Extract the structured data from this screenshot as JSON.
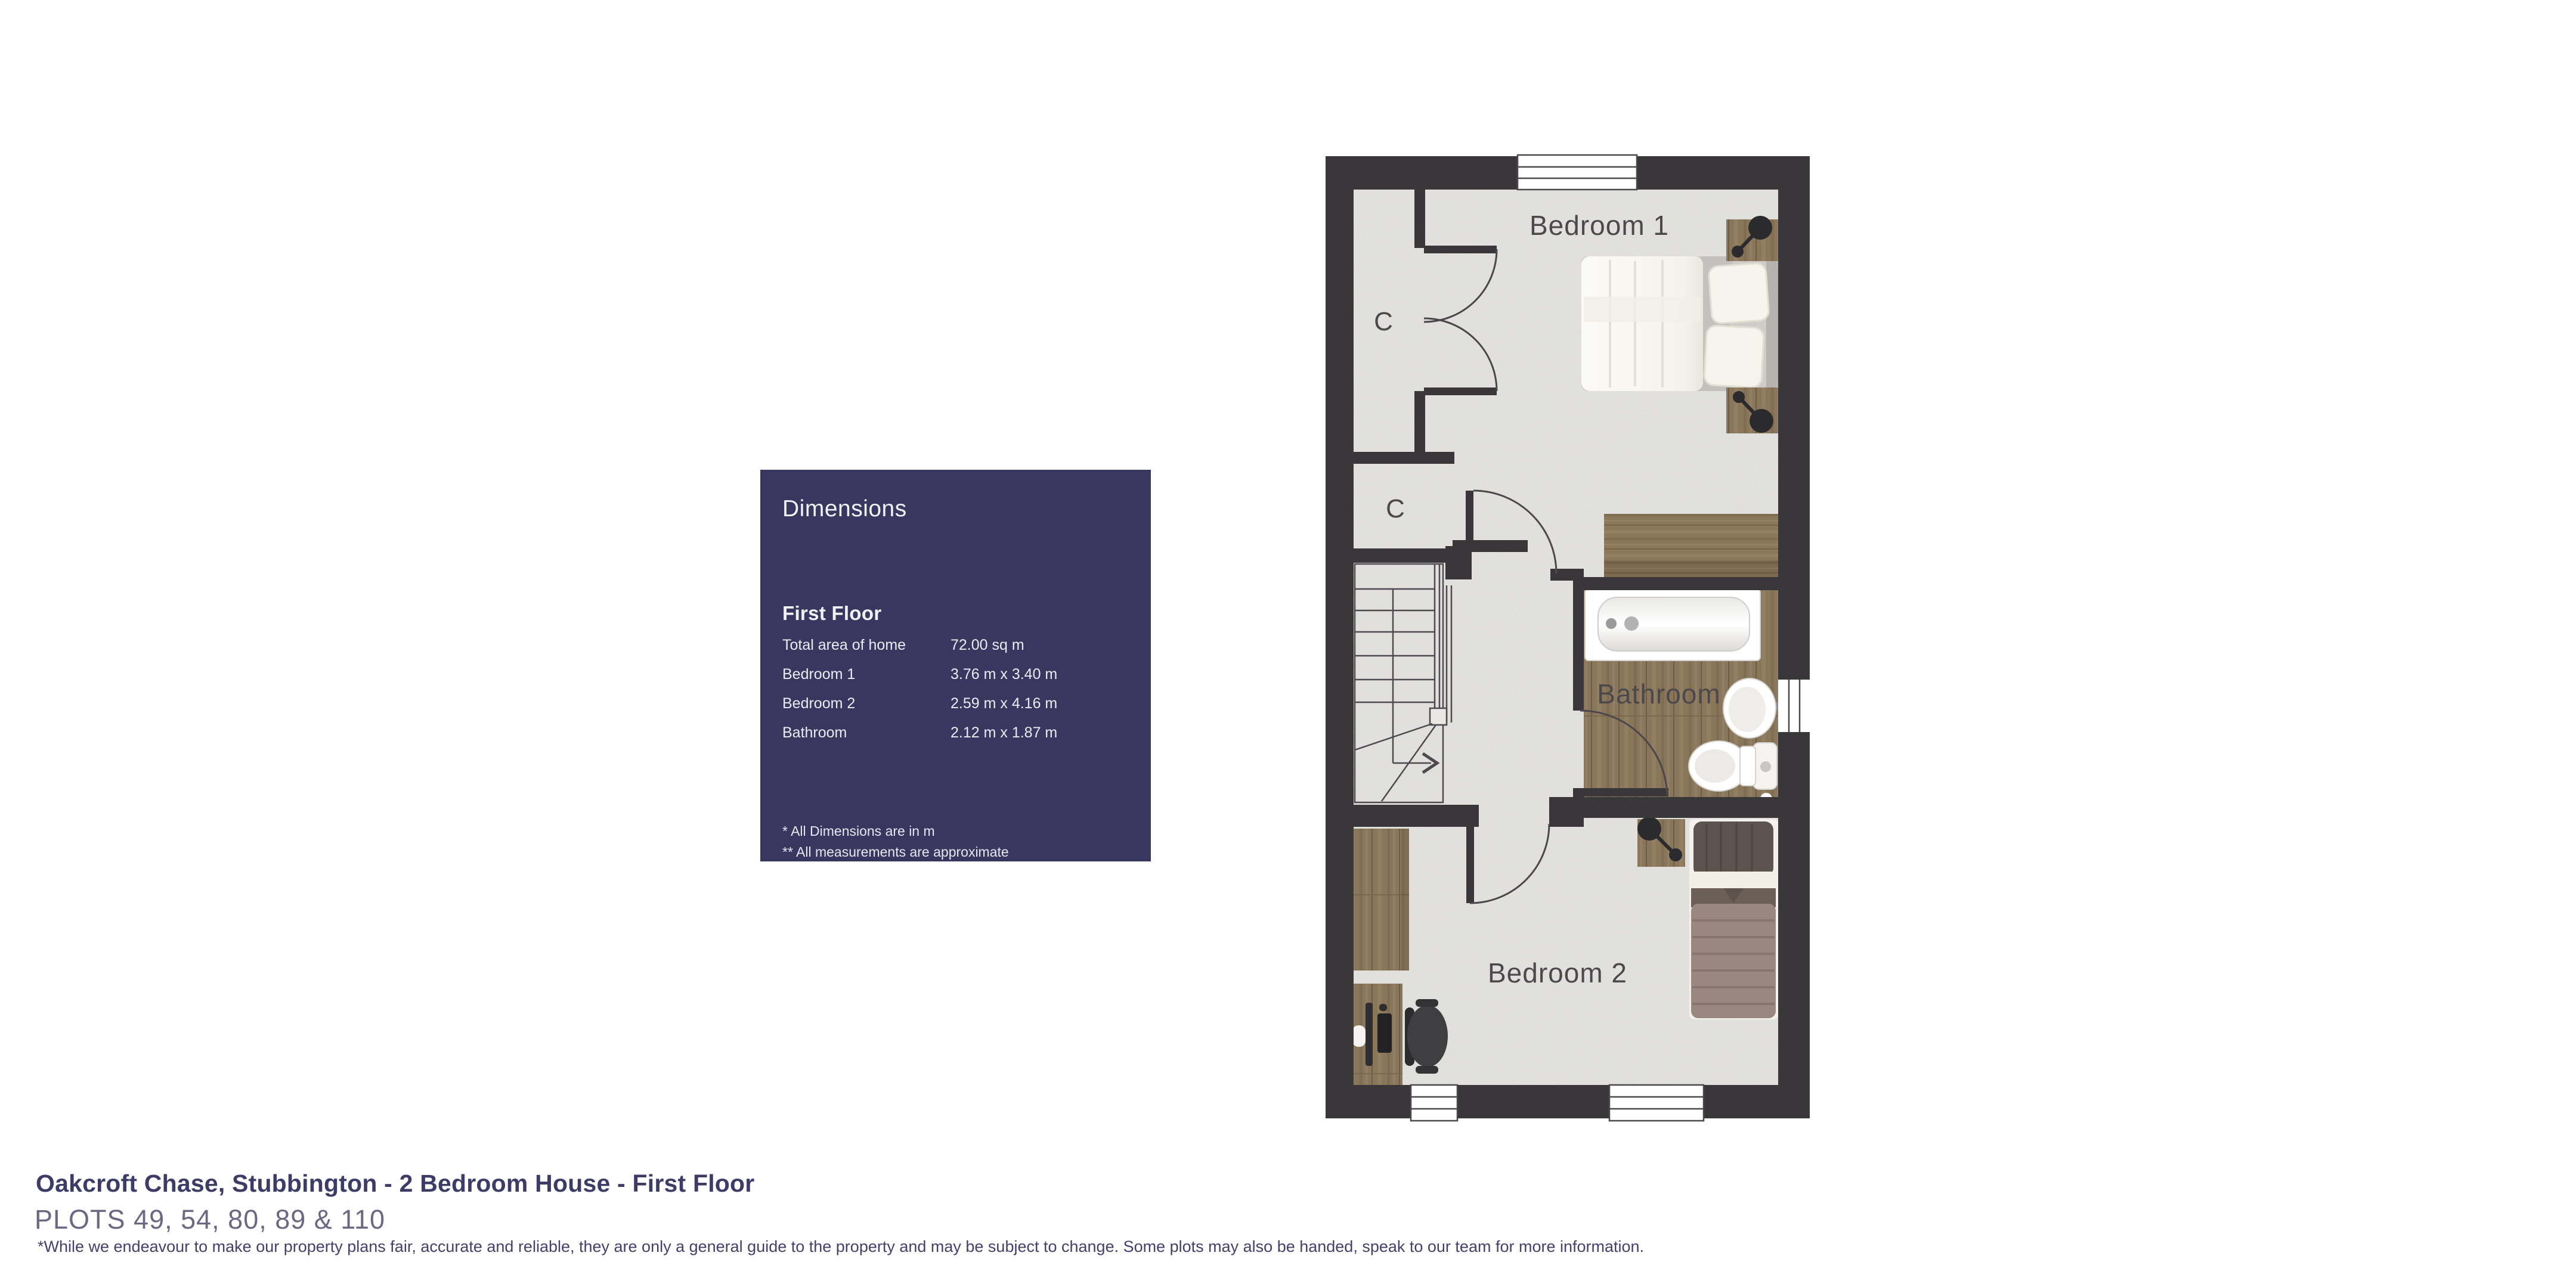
{
  "panel": {
    "title": "Dimensions",
    "section": "First Floor",
    "rows": [
      {
        "label": "Total area of home",
        "value": "72.00 sq m"
      },
      {
        "label": "Bedroom 1",
        "value": "3.76 m x 3.40 m"
      },
      {
        "label": "Bedroom 2",
        "value": "2.59 m x 4.16 m"
      },
      {
        "label": "Bathroom",
        "value": "2.12 m x 1.87 m"
      }
    ],
    "footnotes": [
      "* All Dimensions are in m",
      "** All measurements are approximate"
    ],
    "background_color": "#393660"
  },
  "floorplan": {
    "rooms": {
      "bedroom1": "Bedroom 1",
      "bedroom2": "Bedroom 2",
      "bathroom": "Bathroom",
      "closet1": "C",
      "closet2": "C"
    },
    "colors": {
      "wall": "#3a373a",
      "carpet": "#e8e7e4",
      "wood_floor": "#8a765a",
      "furniture_wood": "#8b7759"
    }
  },
  "footer": {
    "title": "Oakcroft Chase, Stubbington - 2 Bedroom House - First Floor",
    "plots": "PLOTS 49, 54, 80, 89 & 110",
    "disclaimer": "*While we endeavour to make our property plans fair, accurate and reliable, they are only a general guide to the property and may be subject to change. Some plots may also be handed, speak to our team for more information."
  }
}
